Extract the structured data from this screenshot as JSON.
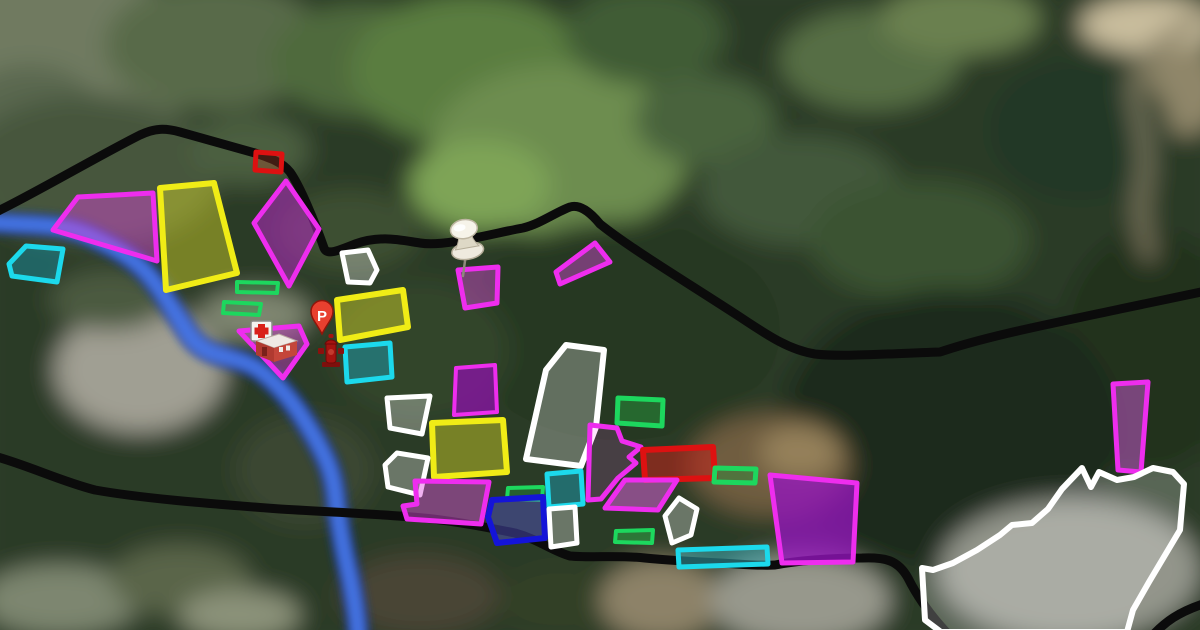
{
  "map": {
    "title": "Satellite map with zoning annotation overlay",
    "markers": {
      "parking_pin": {
        "label": "P",
        "x": 322,
        "y": 334,
        "color": "#e8402f"
      },
      "pushpin": {
        "x": 463,
        "y": 276
      },
      "fire_hydrant": {
        "x": 331,
        "y": 367
      },
      "hospital": {
        "x": 251,
        "y": 321
      }
    },
    "boundary": {
      "color": "#0b0b0b",
      "width": 9,
      "paths": [
        "M -6 213 C 30 196 100 155 140 135 C 155 128 165 128 180 132 L 255 153 C 270 158 282 162 290 172 C 300 186 315 222 324 248 C 327 255 335 252 355 244 C 380 235 400 240 420 243 C 445 247 490 234 523 228 C 540 224 556 212 570 207 C 580 204 590 212 600 224 C 630 248 680 278 740 317 C 770 337 790 350 815 354 C 840 357 880 354 940 352 C 990 335 1060 322 1120 309 L 1206 291",
        "M -6 456 C 30 466 60 481 95 490 C 140 498 200 503 280 509 C 330 512 380 514 423 518 C 455 521 490 528 515 533 C 540 540 552 551 570 556 C 590 558 620 555 645 558 C 665 560 700 562 720 563 C 740 564 760 566 775 565 C 795 561 830 558 862 558 C 885 557 898 560 908 578 C 918 598 930 615 948 634",
        "M 1152 636 C 1165 622 1178 612 1206 603"
      ]
    },
    "river": {
      "color_outer": "#1c3fae",
      "color_inner": "#4677e8",
      "path": "M -8 222 C 30 226 60 222 90 236 C 120 250 140 262 155 283 C 168 300 178 318 190 336 C 210 362 235 352 262 372 C 285 390 300 412 315 438 C 326 458 332 470 335 492 C 338 520 344 552 350 578 C 354 598 357 615 358 634"
    },
    "zones": [
      {
        "name": "red-outline-north",
        "stroke": "#dd1111",
        "fill": "rgba(190,70,40,0.30)",
        "stroke_width": 5,
        "points": [
          [
            256,
            152
          ],
          [
            282,
            154
          ],
          [
            281,
            172
          ],
          [
            255,
            170
          ]
        ]
      },
      {
        "name": "magenta-west-large",
        "stroke": "#ee2dee",
        "fill": "rgba(220,70,220,0.45)",
        "stroke_width": 5,
        "points": [
          [
            53,
            230
          ],
          [
            78,
            197
          ],
          [
            153,
            193
          ],
          [
            157,
            261
          ],
          [
            100,
            244
          ]
        ]
      },
      {
        "name": "yellow-west",
        "stroke": "#f0ec16",
        "fill": "rgba(235,235,40,0.40)",
        "stroke_width": 6,
        "points": [
          [
            160,
            188
          ],
          [
            214,
            183
          ],
          [
            237,
            273
          ],
          [
            166,
            290
          ]
        ]
      },
      {
        "name": "magenta-diamond-west",
        "stroke": "#ee2dee",
        "fill": "rgba(180,40,195,0.55)",
        "stroke_width": 5,
        "points": [
          [
            286,
            181
          ],
          [
            319,
            229
          ],
          [
            289,
            286
          ],
          [
            254,
            223
          ]
        ]
      },
      {
        "name": "cyan-pond-west",
        "stroke": "#1cd9ec",
        "fill": "rgba(25,135,150,0.55)",
        "stroke_width": 5,
        "points": [
          [
            26,
            246
          ],
          [
            63,
            249
          ],
          [
            57,
            282
          ],
          [
            12,
            276
          ],
          [
            9,
            264
          ]
        ]
      },
      {
        "name": "green-strip-1",
        "stroke": "#1dd75e",
        "fill": "rgba(35,150,60,0.35)",
        "stroke_width": 4,
        "points": [
          [
            237,
            282
          ],
          [
            278,
            283
          ],
          [
            277,
            293
          ],
          [
            237,
            292
          ]
        ]
      },
      {
        "name": "green-strip-2",
        "stroke": "#1dd75e",
        "fill": "rgba(35,150,60,0.35)",
        "stroke_width": 4,
        "points": [
          [
            224,
            302
          ],
          [
            261,
            304
          ],
          [
            259,
            315
          ],
          [
            223,
            313
          ]
        ]
      },
      {
        "name": "magenta-hospital",
        "stroke": "#ee2dee",
        "fill": "rgba(205,60,205,0.45)",
        "stroke_width": 5,
        "points": [
          [
            239,
            331
          ],
          [
            299,
            326
          ],
          [
            307,
            344
          ],
          [
            283,
            378
          ]
        ]
      },
      {
        "name": "white-small-a",
        "stroke": "#ffffff",
        "fill": "rgba(255,255,255,0.30)",
        "stroke_width": 5,
        "points": [
          [
            342,
            253
          ],
          [
            368,
            250
          ],
          [
            377,
            270
          ],
          [
            370,
            283
          ],
          [
            348,
            282
          ]
        ]
      },
      {
        "name": "yellow-mid-a",
        "stroke": "#f0ec16",
        "fill": "rgba(235,235,40,0.40)",
        "stroke_width": 6,
        "points": [
          [
            337,
            300
          ],
          [
            403,
            290
          ],
          [
            408,
            327
          ],
          [
            340,
            340
          ]
        ]
      },
      {
        "name": "cyan-mid-a",
        "stroke": "#1cd9ec",
        "fill": "rgba(30,150,165,0.55)",
        "stroke_width": 5,
        "points": [
          [
            345,
            347
          ],
          [
            390,
            343
          ],
          [
            392,
            377
          ],
          [
            347,
            382
          ]
        ]
      },
      {
        "name": "magenta-pin-quad",
        "stroke": "#ee2dee",
        "fill": "rgba(215,75,215,0.45)",
        "stroke_width": 5,
        "points": [
          [
            458,
            270
          ],
          [
            498,
            267
          ],
          [
            497,
            303
          ],
          [
            465,
            308
          ]
        ]
      },
      {
        "name": "magenta-tri-north",
        "stroke": "#ee2dee",
        "fill": "rgba(215,75,215,0.45)",
        "stroke_width": 5,
        "points": [
          [
            595,
            243
          ],
          [
            610,
            262
          ],
          [
            560,
            284
          ],
          [
            556,
            272
          ]
        ]
      },
      {
        "name": "purple-mid",
        "stroke": "#ee2dee",
        "fill": "rgba(140,18,170,0.75)",
        "stroke_width": 4,
        "points": [
          [
            456,
            368
          ],
          [
            495,
            365
          ],
          [
            497,
            412
          ],
          [
            454,
            415
          ]
        ]
      },
      {
        "name": "white-small-b",
        "stroke": "#ffffff",
        "fill": "rgba(255,255,255,0.30)",
        "stroke_width": 5,
        "points": [
          [
            387,
            398
          ],
          [
            430,
            396
          ],
          [
            422,
            434
          ],
          [
            390,
            428
          ]
        ]
      },
      {
        "name": "yellow-mid-b",
        "stroke": "#f0ec16",
        "fill": "rgba(235,235,40,0.40)",
        "stroke_width": 6,
        "points": [
          [
            432,
            423
          ],
          [
            503,
            420
          ],
          [
            507,
            472
          ],
          [
            434,
            477
          ]
        ]
      },
      {
        "name": "white-small-c",
        "stroke": "#ffffff",
        "fill": "rgba(255,255,255,0.30)",
        "stroke_width": 5,
        "points": [
          [
            397,
            453
          ],
          [
            428,
            458
          ],
          [
            420,
            495
          ],
          [
            388,
            487
          ],
          [
            385,
            465
          ]
        ]
      },
      {
        "name": "magenta-notch-south",
        "stroke": "#ee2dee",
        "fill": "rgba(225,85,225,0.45)",
        "stroke_width": 5,
        "points": [
          [
            415,
            481
          ],
          [
            489,
            482
          ],
          [
            481,
            524
          ],
          [
            407,
            519
          ],
          [
            403,
            506
          ],
          [
            417,
            504
          ]
        ]
      },
      {
        "name": "white-tall-mid",
        "stroke": "#ffffff",
        "fill": "rgba(255,255,255,0.28)",
        "stroke_width": 6,
        "points": [
          [
            566,
            345
          ],
          [
            604,
            350
          ],
          [
            596,
            427
          ],
          [
            581,
            466
          ],
          [
            526,
            459
          ],
          [
            546,
            370
          ]
        ]
      },
      {
        "name": "green-small-mid",
        "stroke": "#1dd75e",
        "fill": "rgba(35,150,60,0.40)",
        "stroke_width": 4,
        "points": [
          [
            508,
            488
          ],
          [
            543,
            487
          ],
          [
            542,
            500
          ],
          [
            507,
            499
          ]
        ]
      },
      {
        "name": "cyan-mid-b",
        "stroke": "#1cd9ec",
        "fill": "rgba(30,150,165,0.55)",
        "stroke_width": 5,
        "points": [
          [
            547,
            474
          ],
          [
            581,
            471
          ],
          [
            583,
            504
          ],
          [
            549,
            507
          ]
        ]
      },
      {
        "name": "blue-zone",
        "stroke": "#1414d8",
        "fill": "rgba(85,85,205,0.45)",
        "stroke_width": 6,
        "points": [
          [
            492,
            500
          ],
          [
            543,
            497
          ],
          [
            545,
            538
          ],
          [
            497,
            543
          ],
          [
            488,
            517
          ]
        ]
      },
      {
        "name": "white-small-d",
        "stroke": "#ffffff",
        "fill": "rgba(255,255,255,0.30)",
        "stroke_width": 5,
        "points": [
          [
            549,
            509
          ],
          [
            575,
            507
          ],
          [
            577,
            543
          ],
          [
            551,
            547
          ]
        ]
      },
      {
        "name": "green-east-a",
        "stroke": "#1dd75e",
        "fill": "rgba(40,165,65,0.45)",
        "stroke_width": 5,
        "points": [
          [
            618,
            398
          ],
          [
            663,
            400
          ],
          [
            662,
            426
          ],
          [
            617,
            423
          ]
        ]
      },
      {
        "name": "magenta-irregular-east",
        "stroke": "#ee2dee",
        "fill": "rgba(240,90,240,0.15)",
        "stroke_width": 5,
        "points": [
          [
            590,
            425
          ],
          [
            617,
            428
          ],
          [
            622,
            441
          ],
          [
            641,
            447
          ],
          [
            629,
            457
          ],
          [
            636,
            463
          ],
          [
            618,
            478
          ],
          [
            601,
            499
          ],
          [
            588,
            500
          ]
        ]
      },
      {
        "name": "red-filled-east",
        "stroke": "#dd1111",
        "fill": "rgba(195,35,25,0.55)",
        "stroke_width": 6,
        "points": [
          [
            643,
            450
          ],
          [
            713,
            447
          ],
          [
            715,
            478
          ],
          [
            645,
            480
          ]
        ]
      },
      {
        "name": "green-east-b",
        "stroke": "#1dd75e",
        "fill": "rgba(35,150,60,0.40)",
        "stroke_width": 5,
        "points": [
          [
            715,
            468
          ],
          [
            756,
            469
          ],
          [
            755,
            483
          ],
          [
            714,
            482
          ]
        ]
      },
      {
        "name": "magenta-para-south",
        "stroke": "#ee2dee",
        "fill": "rgba(230,100,230,0.50)",
        "stroke_width": 5,
        "points": [
          [
            605,
            508
          ],
          [
            625,
            480
          ],
          [
            677,
            480
          ],
          [
            658,
            510
          ]
        ]
      },
      {
        "name": "white-pentagon-south",
        "stroke": "#ffffff",
        "fill": "rgba(255,255,255,0.30)",
        "stroke_width": 5,
        "points": [
          [
            679,
            498
          ],
          [
            697,
            509
          ],
          [
            691,
            535
          ],
          [
            672,
            543
          ],
          [
            665,
            516
          ]
        ]
      },
      {
        "name": "green-filled-south",
        "stroke": "#1dd75e",
        "fill": "rgba(45,170,70,0.55)",
        "stroke_width": 4,
        "points": [
          [
            616,
            531
          ],
          [
            653,
            530
          ],
          [
            652,
            543
          ],
          [
            615,
            542
          ]
        ]
      },
      {
        "name": "cyan-long-south",
        "stroke": "#1cd9ec",
        "fill": "rgba(55,175,185,0.50)",
        "stroke_width": 5,
        "points": [
          [
            678,
            550
          ],
          [
            767,
            547
          ],
          [
            768,
            564
          ],
          [
            679,
            567
          ]
        ]
      },
      {
        "name": "purple-east-large",
        "stroke": "#ee2dee",
        "fill": "rgba(148,20,188,0.78)",
        "stroke_width": 5,
        "points": [
          [
            770,
            475
          ],
          [
            857,
            483
          ],
          [
            853,
            562
          ],
          [
            782,
            563
          ]
        ]
      },
      {
        "name": "magenta-tall-east",
        "stroke": "#ee2dee",
        "fill": "rgba(205,90,215,0.50)",
        "stroke_width": 5,
        "points": [
          [
            1113,
            384
          ],
          [
            1148,
            382
          ],
          [
            1141,
            472
          ],
          [
            1118,
            470
          ]
        ]
      },
      {
        "name": "white-blob-southeast",
        "stroke": "#ffffff",
        "fill": "rgba(255,255,255,0.22)",
        "stroke_width": 6,
        "points": [
          [
            922,
            568
          ],
          [
            933,
            570
          ],
          [
            953,
            563
          ],
          [
            977,
            550
          ],
          [
            1000,
            535
          ],
          [
            1012,
            525
          ],
          [
            1032,
            523
          ],
          [
            1048,
            509
          ],
          [
            1062,
            489
          ],
          [
            1082,
            468
          ],
          [
            1091,
            487
          ],
          [
            1099,
            472
          ],
          [
            1117,
            480
          ],
          [
            1134,
            477
          ],
          [
            1153,
            468
          ],
          [
            1173,
            472
          ],
          [
            1184,
            484
          ],
          [
            1180,
            530
          ],
          [
            1149,
            582
          ],
          [
            1133,
            610
          ],
          [
            1127,
            632
          ],
          [
            941,
            632
          ],
          [
            925,
            620
          ]
        ]
      }
    ]
  }
}
